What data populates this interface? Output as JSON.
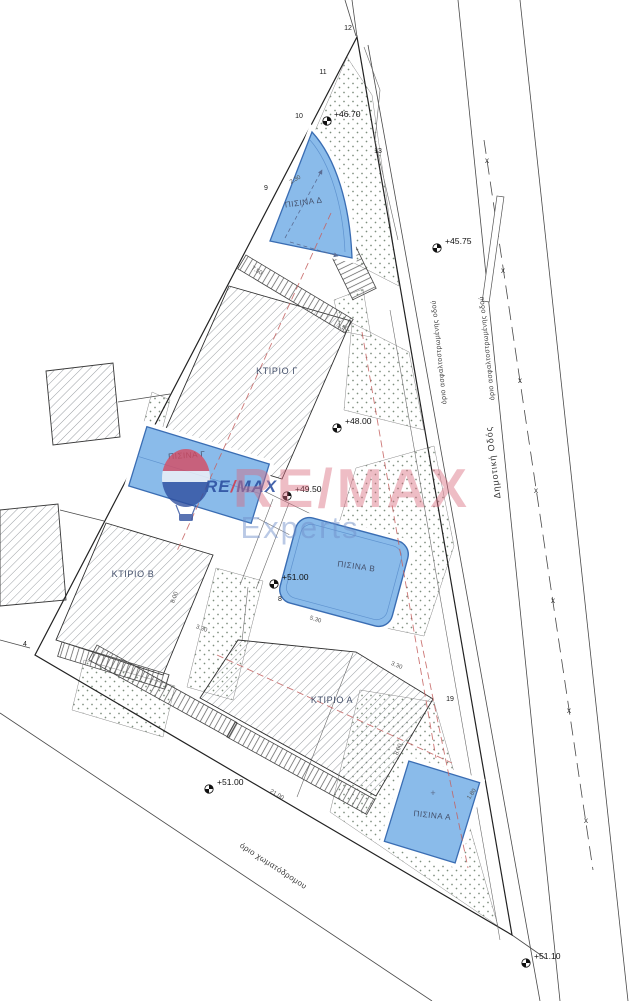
{
  "colors": {
    "pool_fill": "#8ABBEA",
    "pool_border": "#3A6DB3",
    "hatch_line": "#70757C",
    "stipple_dot": "#7E8E7E",
    "red_dash": "#C4605F",
    "logo_blue": "#2B4EA0",
    "logo_red": "#D23B4E",
    "watermark_pink": "#D8687C",
    "watermark_blue": "#708EC8"
  },
  "drawing": {
    "buildings": [
      {
        "label": "ΚΤΙΡΙΟ Γ"
      },
      {
        "label": "ΚΤΙΡΙΟ Β"
      },
      {
        "label": "ΚΤΙΡΙΟ Α"
      }
    ],
    "pools": [
      {
        "label": "ΠΙΣΙΝΑ Δ"
      },
      {
        "label": "ΠΙΣΙΝΑ Γ"
      },
      {
        "label": "ΠΙΣΙΝΑ Β"
      },
      {
        "label": "ΠΙΣΙΝΑ Α"
      }
    ],
    "pool_a_cross": "+",
    "roads": {
      "municipal_road": "Δημοτική Οδός",
      "asphalt_edge_1": "όριο ασφαλτοστρωμένης οδού",
      "asphalt_edge_2": "όριο ασφαλτοστρωμένης οδού",
      "dirt_road_edge": "όριο χωματόδρομου",
      "fence_symbol": "x"
    },
    "elevation_markers": [
      {
        "value": "+46.70",
        "sx": 327,
        "sy": 121,
        "tx": 334,
        "ty": 117
      },
      {
        "value": "+45.75",
        "sx": 437,
        "sy": 248,
        "tx": 445,
        "ty": 244
      },
      {
        "value": "+48.00",
        "sx": 337,
        "sy": 428,
        "tx": 345,
        "ty": 424
      },
      {
        "value": "+49.50",
        "sx": 287,
        "sy": 496,
        "tx": 295,
        "ty": 492
      },
      {
        "value": "+51.00",
        "sx": 274,
        "sy": 584,
        "tx": 282,
        "ty": 580
      },
      {
        "value": "+51.00",
        "sx": 209,
        "sy": 789,
        "tx": 217,
        "ty": 785
      },
      {
        "value": "+51.10",
        "sx": 526,
        "sy": 963,
        "tx": 534,
        "ty": 959
      }
    ],
    "vertex_numbers": [
      {
        "n": "12",
        "x": 348,
        "y": 30
      },
      {
        "n": "11",
        "x": 323,
        "y": 74
      },
      {
        "n": "10",
        "x": 299,
        "y": 118
      },
      {
        "n": "13",
        "x": 378,
        "y": 153
      },
      {
        "n": "9",
        "x": 266,
        "y": 190
      },
      {
        "n": "8",
        "x": 280,
        "y": 601
      },
      {
        "n": "4",
        "x": 25,
        "y": 646
      },
      {
        "n": "19",
        "x": 450,
        "y": 701
      }
    ],
    "dimensions": [
      {
        "v": "2.30",
        "x": 296,
        "y": 181,
        "r": -30
      },
      {
        "v": "1.50",
        "x": 342,
        "y": 329,
        "r": 22
      },
      {
        "v": "7.50",
        "x": 256,
        "y": 272,
        "r": 31
      },
      {
        "v": "5.30",
        "x": 315,
        "y": 621,
        "r": 17
      },
      {
        "v": "3.30",
        "x": 201,
        "y": 630,
        "r": 20
      },
      {
        "v": "8.00",
        "x": 176,
        "y": 598,
        "r": -70
      },
      {
        "v": "3.30",
        "x": 396,
        "y": 667,
        "r": 22
      },
      {
        "v": "8.00",
        "x": 400,
        "y": 750,
        "r": -68
      },
      {
        "v": "21.00",
        "x": 276,
        "y": 796,
        "r": 31
      },
      {
        "v": "1.80",
        "x": 473,
        "y": 795,
        "r": -55
      }
    ],
    "fence_marks": [
      {
        "x": 487,
        "y": 163
      },
      {
        "x": 503,
        "y": 273
      },
      {
        "x": 520,
        "y": 383
      },
      {
        "x": 536,
        "y": 493
      },
      {
        "x": 553,
        "y": 603
      },
      {
        "x": 569,
        "y": 713
      },
      {
        "x": 586,
        "y": 823
      }
    ]
  },
  "watermark": {
    "wordmark_small_re": "RE",
    "wordmark_small_slash": "/",
    "wordmark_small_max": "MAX",
    "wordmark_large": "RE/MAX",
    "subbrand": "Experts"
  }
}
